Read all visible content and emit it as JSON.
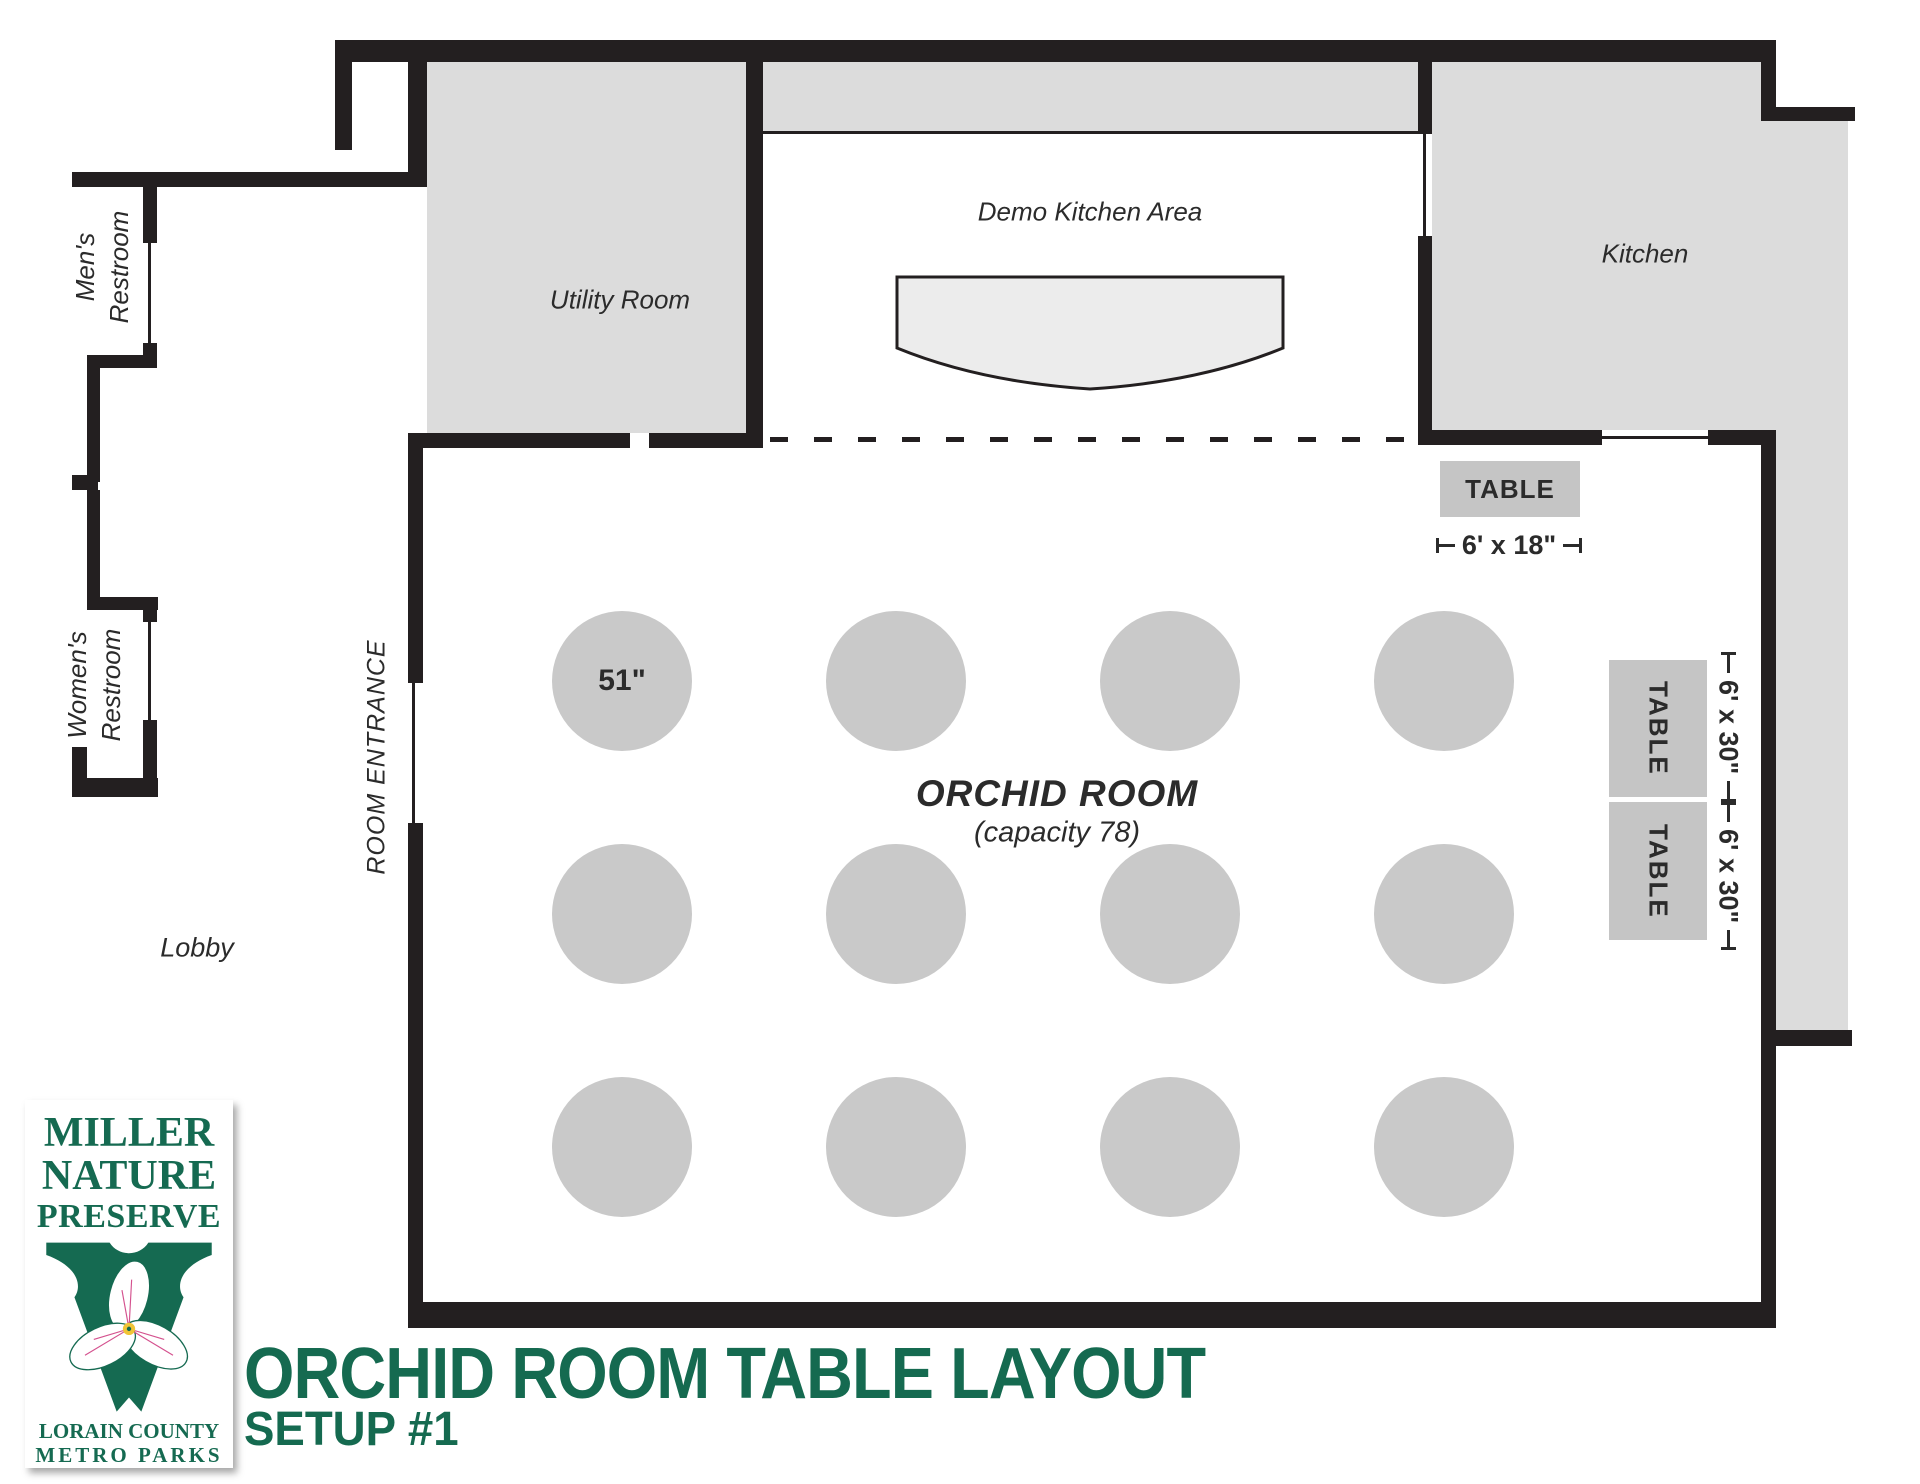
{
  "header": {
    "title": "ORCHID ROOM TABLE LAYOUT",
    "subtitle": "SETUP #1"
  },
  "logo": {
    "name_line1": "MILLER",
    "name_line2": "NATURE",
    "name_line3": "PRESERVE",
    "org_line1": "LORAIN COUNTY",
    "org_line2": "METRO PARKS"
  },
  "rooms": {
    "mens_restroom_line1": "Men's",
    "mens_restroom_line2": "Restroom",
    "womens_restroom_line1": "Women's",
    "womens_restroom_line2": "Restroom",
    "lobby": "Lobby",
    "utility_room": "Utility Room",
    "demo_kitchen_area": "Demo Kitchen Area",
    "kitchen": "Kitchen",
    "orchid_room_name": "ORCHID ROOM",
    "orchid_room_capacity": "(capacity 78)",
    "room_entrance": "ROOM ENTRANCE"
  },
  "tables": {
    "rect_table_label": "TABLE",
    "head_table_dimension": "6' x 18\"",
    "side_table_dimension": "6' x 30\"",
    "round_table_size": "51\"",
    "round_table_count": 12
  },
  "colors": {
    "wall": "#231f20",
    "room_fill": "#dcdcdc",
    "round_table_fill": "#c9c9c9",
    "rect_table_fill": "#c5c5c5",
    "brand_green": "#156a51"
  }
}
